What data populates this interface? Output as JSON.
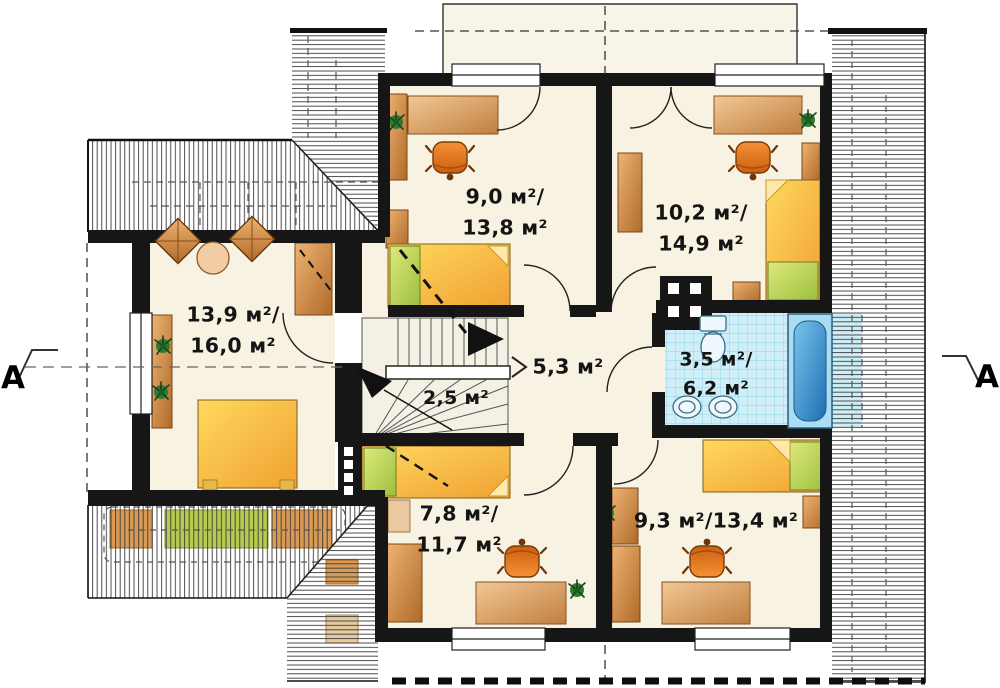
{
  "plan": {
    "rooms": [
      {
        "id": "bedroom-top-left",
        "line1": "9,0 м²/",
        "line2": "13,8 м²"
      },
      {
        "id": "bedroom-top-right",
        "line1": "10,2 м²/",
        "line2": "14,9 м²"
      },
      {
        "id": "bedroom-left",
        "line1": "13,9 м²/",
        "line2": "16,0 м²"
      },
      {
        "id": "staircase",
        "line1": "2,5 м²"
      },
      {
        "id": "hall",
        "line1": "5,3 м²"
      },
      {
        "id": "bathroom",
        "line1": "3,5 м²/",
        "line2": "6,2 м²"
      },
      {
        "id": "bedroom-bottom-left",
        "line1": "7,8 м²/",
        "line2": "11,7 м²"
      },
      {
        "id": "bedroom-bottom-right",
        "line1": "9,3 м²/13,4 м²"
      }
    ],
    "section_markers": {
      "left": "A",
      "right": "A"
    },
    "colors": {
      "wall": "#161616",
      "room_fill": "#f8f2e3",
      "hatch": "#3a3a3a",
      "bath_tile": "#cfeef8",
      "bed_yellow": "#f5a623",
      "pillow_green": "#a9c54a",
      "furniture_wood": "#cf8a42",
      "chair_orange": "#e07818",
      "tub_blue": "#2a7fc0",
      "plant_green": "#2f7a33"
    }
  }
}
